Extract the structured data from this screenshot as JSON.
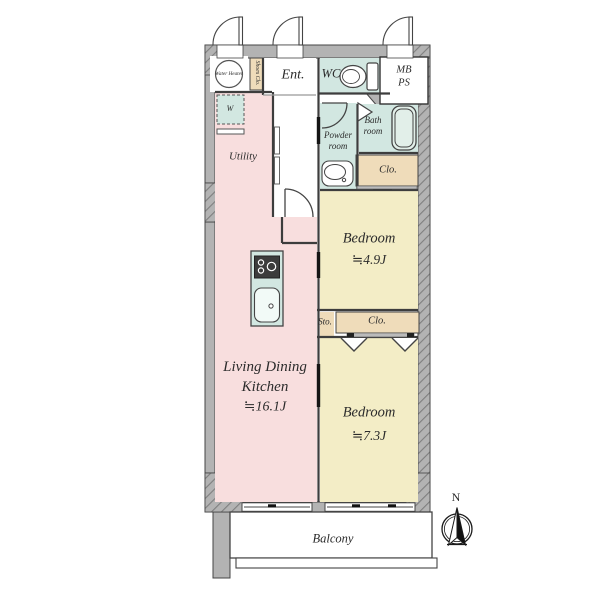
{
  "palette": {
    "wall_gray": "#b3b3b3",
    "room_pink": "#f8dede",
    "room_yellow": "#f3edc6",
    "wet_area_teal": "#d2e7e1",
    "closet_tan": "#efdcba",
    "line_color": "#3d3d3d"
  },
  "rooms": {
    "ldk": {
      "name": "Living Dining Kitchen",
      "area": "≒16.1J"
    },
    "bedroom_small": {
      "name": "Bedroom",
      "area": "≒4.9J"
    },
    "bedroom_large": {
      "name": "Bedroom",
      "area": "≒7.3J"
    },
    "utility": {
      "name": "Utility"
    },
    "entrance": {
      "name": "Ent."
    },
    "wc": {
      "name": "WC"
    },
    "meter_box_pipe_space": {
      "line1": "MB",
      "line2": "PS"
    },
    "powder_room": {
      "name": "Powder room"
    },
    "bath_room": {
      "name": "Bath room"
    },
    "closet_by_bath": {
      "name": "Clo."
    },
    "storage": {
      "name": "Sto."
    },
    "closet_bedroom": {
      "name": "Clo."
    },
    "balcony": {
      "name": "Balcony"
    },
    "shoes_closet": {
      "name": "Shoes Clo."
    },
    "water_heater": {
      "name": "Water Heater"
    },
    "washing_machine": {
      "name": "W"
    }
  },
  "compass": {
    "north_label": "N"
  }
}
